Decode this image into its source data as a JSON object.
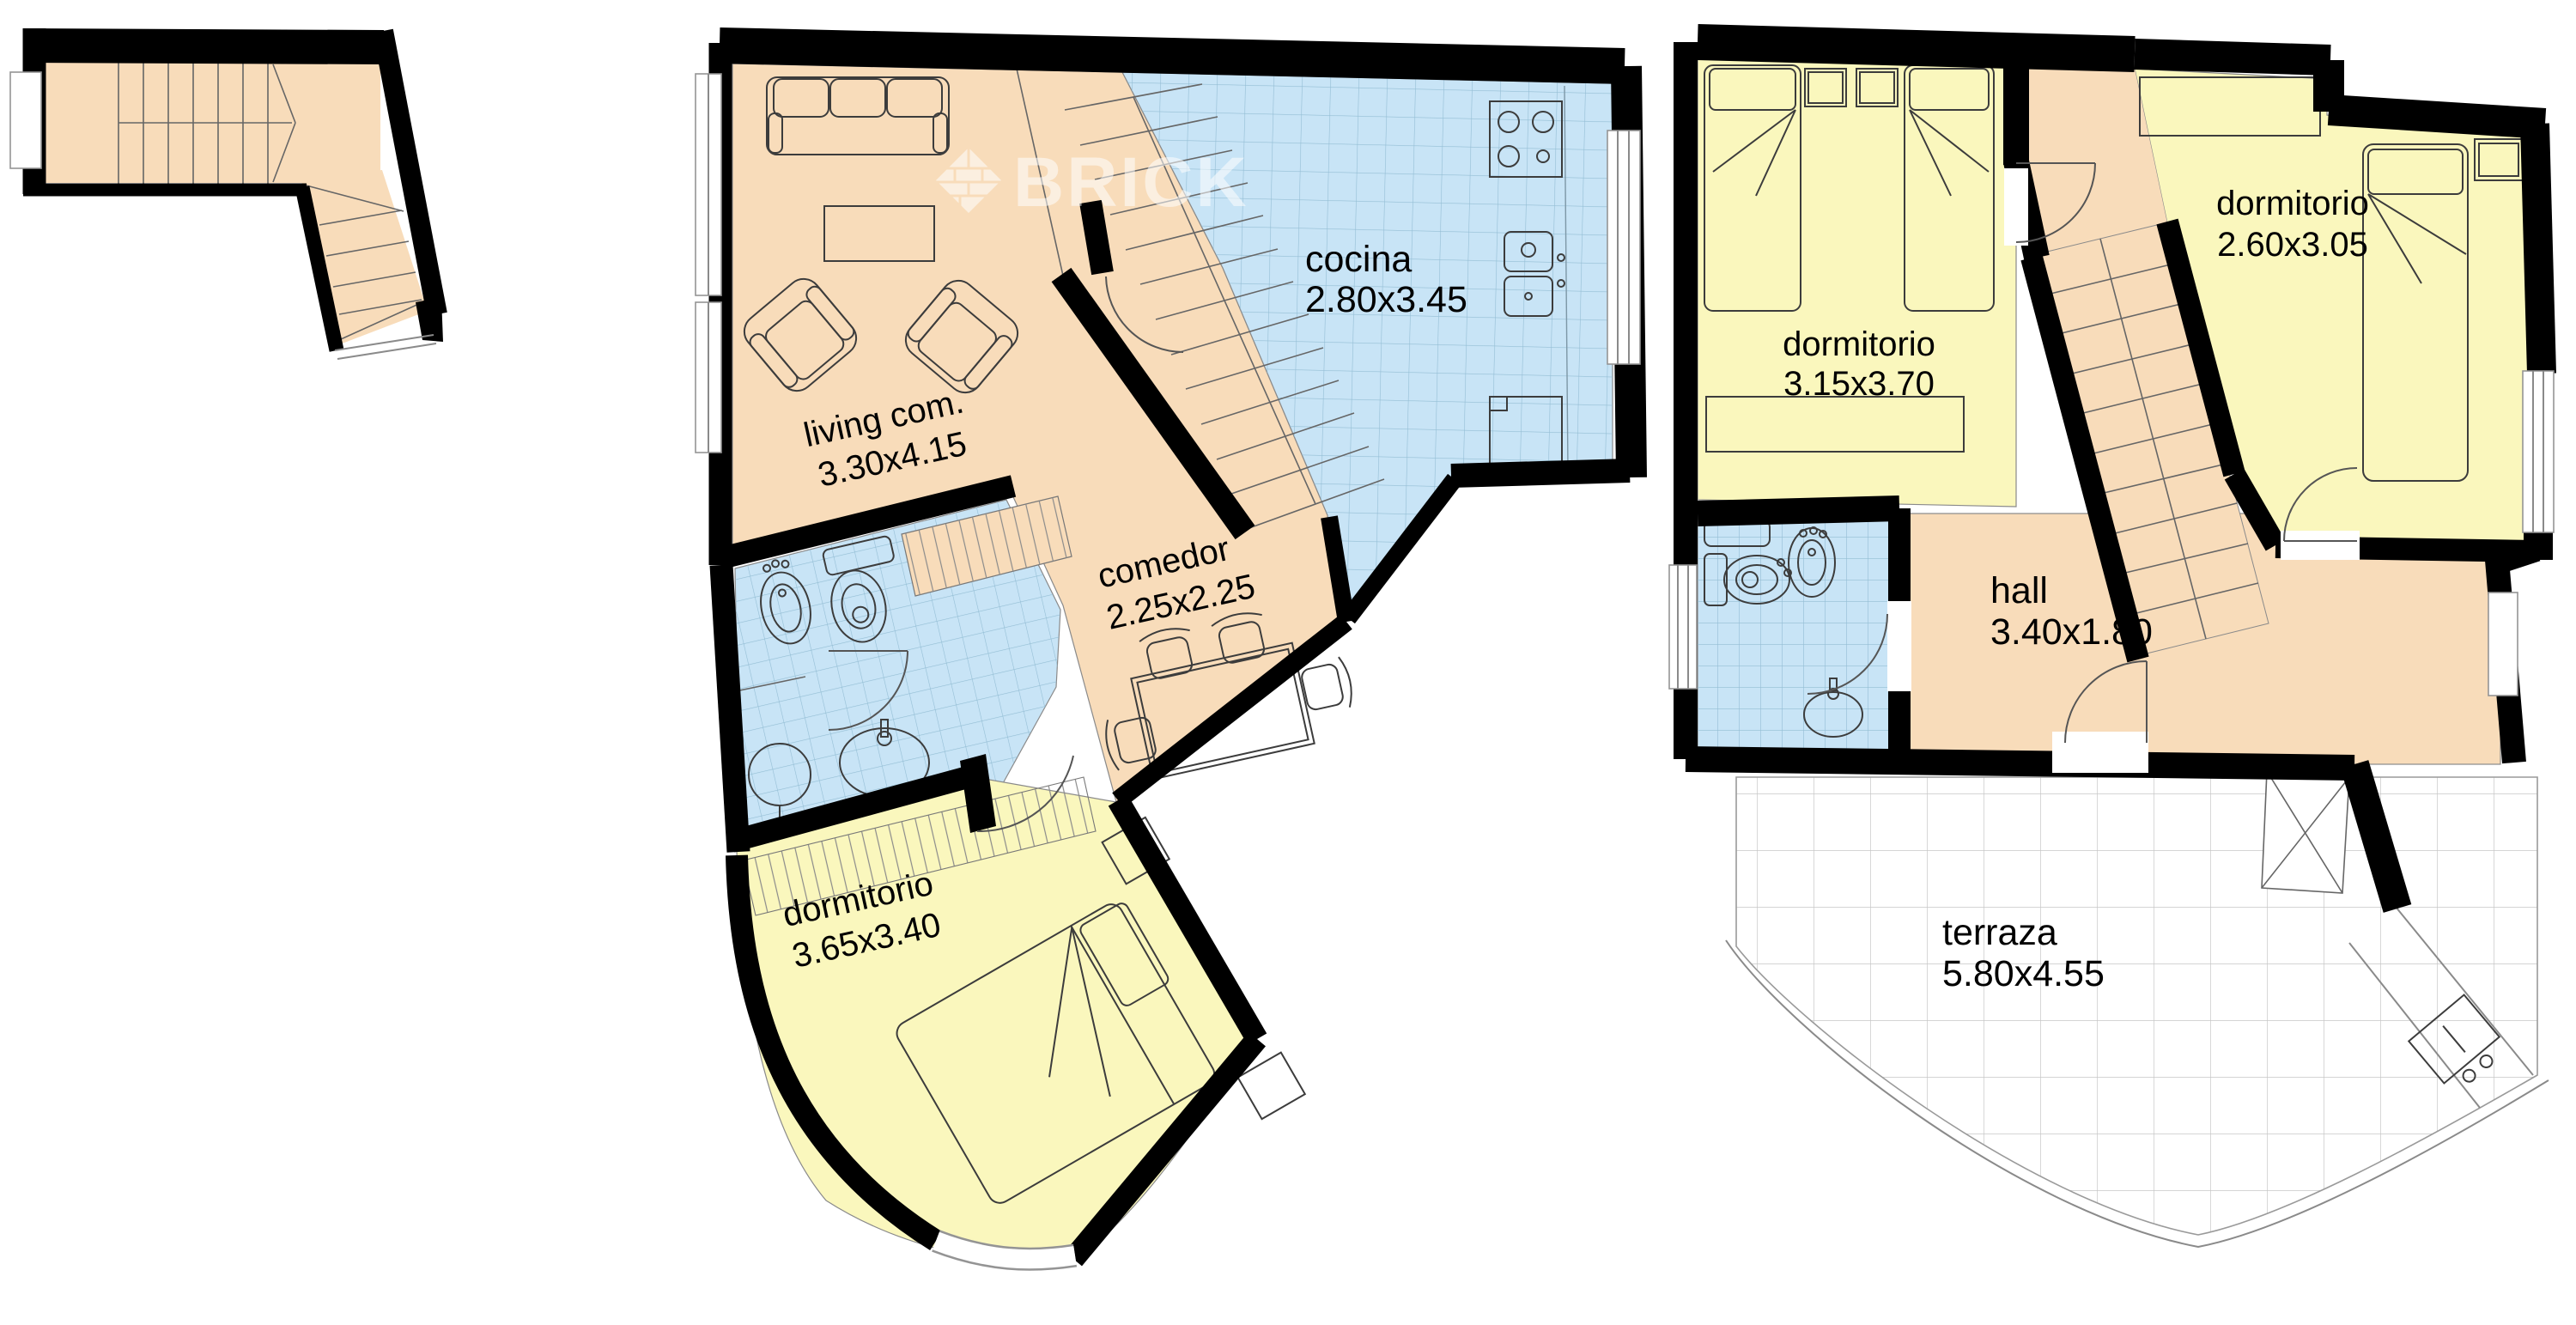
{
  "watermark": {
    "brand": "BRICK"
  },
  "rooms": {
    "living": {
      "name": "living com.",
      "dims": "3.30x4.15"
    },
    "cocina": {
      "name": "cocina",
      "dims": "2.80x3.45"
    },
    "comedor": {
      "name": "comedor",
      "dims": "2.25x2.25"
    },
    "dormitorio_principal": {
      "name": "dormitorio",
      "dims": "3.65x3.40"
    },
    "dormitorio_twin": {
      "name": "dormitorio",
      "dims": "3.15x3.70"
    },
    "dormitorio_suite": {
      "name": "dormitorio",
      "dims": "2.60x3.05"
    },
    "hall": {
      "name": "hall",
      "dims": "3.40x1.80"
    },
    "terraza": {
      "name": "terraza",
      "dims": "5.80x4.55"
    }
  },
  "colors": {
    "wall": "#000000",
    "floor_living": "#F8DCBA",
    "floor_bedroom": "#FAF7BD",
    "floor_wet": "#C8E4F6",
    "terrace": "#FFFFFF",
    "watermark_text": "#FFFFFF"
  }
}
